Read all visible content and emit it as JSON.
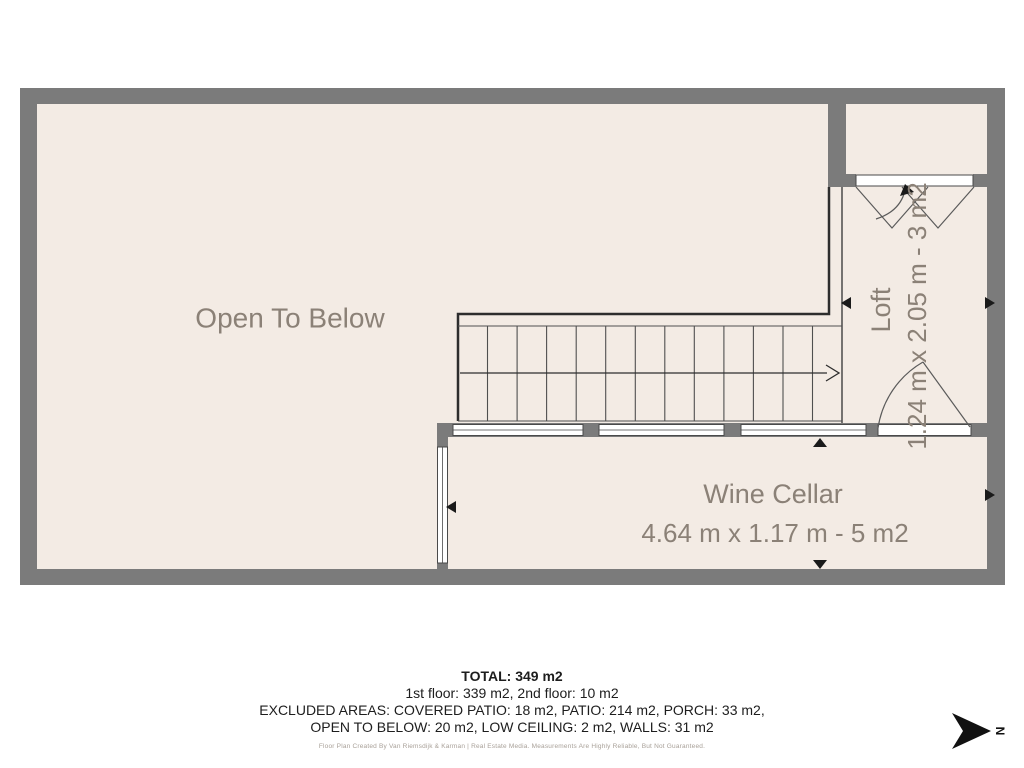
{
  "plan": {
    "rooms": {
      "open_to_below": {
        "label": "Open To Below"
      },
      "loft": {
        "label": "Loft",
        "dimensions": "1.24 m x 2.05 m - 3 m2"
      },
      "wine_cellar": {
        "label": "Wine Cellar",
        "dimensions": "4.64 m x 1.17 m - 5 m2"
      }
    },
    "colors": {
      "wall": "#7b7b7b",
      "floor": "#f3ebe4",
      "label": "#8b8177",
      "line": "#4f4f4f",
      "railing": "#2d2d2d"
    }
  },
  "summary": {
    "total": "TOTAL: 349 m2",
    "floors": "1st floor: 339 m2, 2nd floor: 10 m2",
    "excluded_1": "EXCLUDED AREAS: COVERED PATIO: 18 m2, PATIO: 214 m2, PORCH: 33 m2,",
    "excluded_2": "OPEN TO BELOW: 20 m2, LOW CEILING: 2 m2, WALLS: 31 m2",
    "credit": "Floor Plan Created By Van Riemsdijk & Karman | Real Estate Media. Measurements Are Highly Reliable, But Not Guaranteed."
  },
  "compass": {
    "label": "N"
  }
}
